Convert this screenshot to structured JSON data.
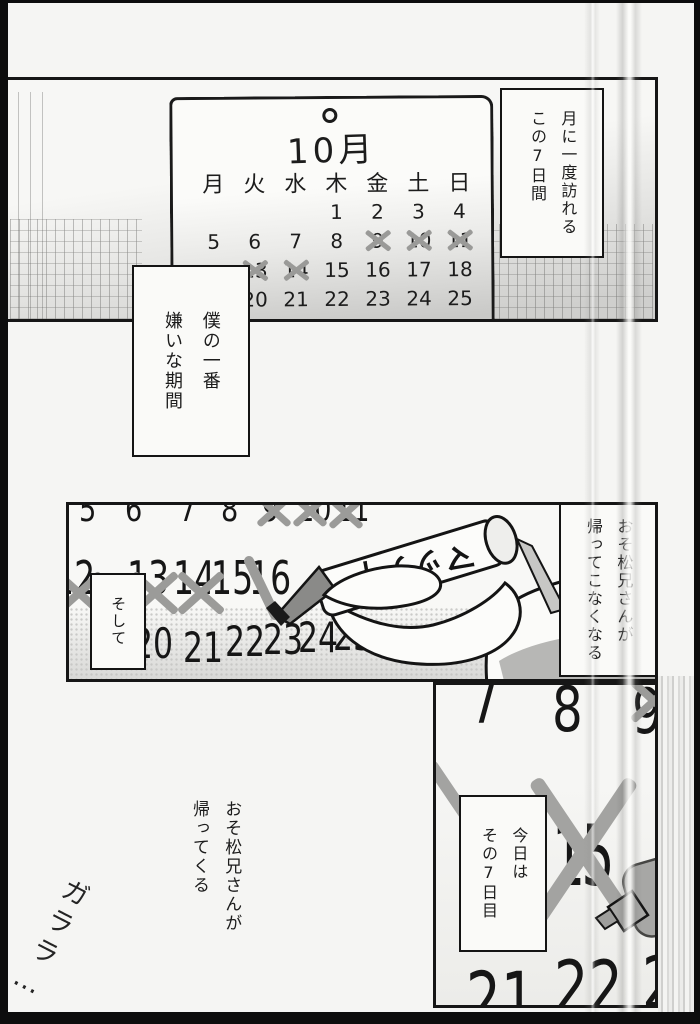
{
  "panel1": {
    "calendar": {
      "month_title": "10月",
      "weekdays": [
        "月",
        "火",
        "水",
        "木",
        "金",
        "土",
        "日"
      ],
      "weeks": [
        [
          "",
          "",
          "",
          "1",
          "2",
          "3",
          "4"
        ],
        [
          "5",
          "6",
          "7",
          "8",
          "9",
          "10",
          "11"
        ],
        [
          "",
          "13",
          "14",
          "15",
          "16",
          "17",
          "18"
        ],
        [
          "",
          "20",
          "21",
          "22",
          "23",
          "24",
          "25"
        ]
      ],
      "crossed_out": [
        "9",
        "10",
        "11",
        "13",
        "14"
      ]
    },
    "caption": {
      "lines": [
        "月に一度訪れる",
        "この7日間"
      ]
    }
  },
  "caption_hate": {
    "lines": [
      "僕の一番",
      "嫌いな期間"
    ]
  },
  "panel2": {
    "caption_soshite": "そして",
    "caption_right": {
      "lines": [
        "おそ松兄さんが",
        "帰ってこなくなる"
      ]
    },
    "marker_label": "マッティ",
    "numbers_top": [
      "5",
      "6",
      "7",
      "8",
      "9",
      "10",
      "11"
    ],
    "numbers_mid": [
      "12",
      "13",
      "14",
      "15",
      "16"
    ],
    "numbers_bottom": [
      "20",
      "21",
      "22",
      "23",
      "24",
      "25"
    ],
    "crossed_out": [
      "9",
      "10",
      "11",
      "12",
      "13",
      "14"
    ],
    "being_crossed": "16"
  },
  "panel3": {
    "numbers_top": [
      "7",
      "8",
      "9"
    ],
    "number_center": "15",
    "numbers_bottom": [
      "21",
      "22",
      "23"
    ],
    "crossed_out": [
      "9",
      "15"
    ],
    "caption": {
      "lines": [
        "今日は",
        "その7日目"
      ]
    }
  },
  "floating_text": {
    "lines": [
      "おそ松兄さんが",
      "帰ってくる"
    ]
  },
  "sfx": "ガララ…",
  "colors": {
    "ink": "#1c1c1c",
    "cross_gray": "#9b9b99",
    "tone_gray": "#b7b7b5",
    "paper": "#f5f5f3"
  }
}
